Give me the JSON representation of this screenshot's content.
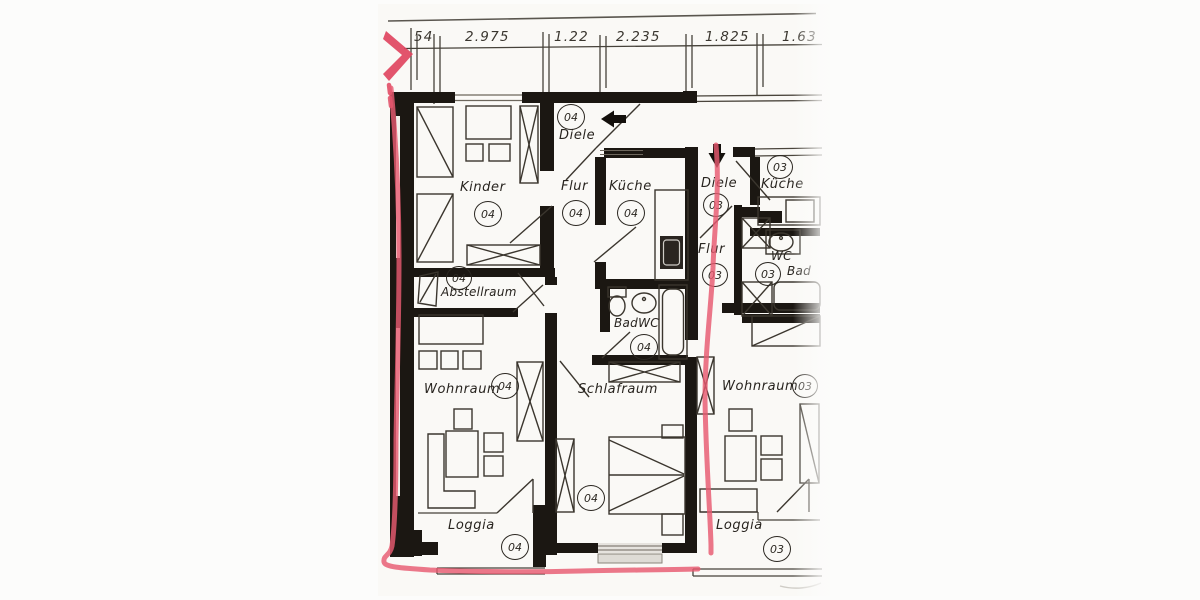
{
  "document": {
    "kind": "scanned apartment floor plan",
    "colors": {
      "marker_pink": "#e85a70",
      "wall_black": "#1b1712",
      "line_gray": "#3b362e",
      "paper": "#fcfcfb"
    }
  },
  "dimensions": {
    "values": [
      "54",
      "2.975",
      "1.22",
      "2.235",
      "1.825",
      "1.63"
    ]
  },
  "rooms": {
    "kinder": {
      "label": "Kinder",
      "num": "04"
    },
    "diele04": {
      "label": "Diele",
      "num": "04"
    },
    "flur04": {
      "label": "Flur",
      "num": "04"
    },
    "kueche04": {
      "label": "Küche",
      "num": "04"
    },
    "abstellraum": {
      "label": "Abstellraum",
      "num": "04"
    },
    "badwc": {
      "label": "BadWC",
      "num": "04"
    },
    "wohnraum04": {
      "label": "Wohnraum",
      "num": "04"
    },
    "schlafraum": {
      "label": "Schlafraum",
      "num": "04"
    },
    "loggia04": {
      "label": "Loggia",
      "num": "04"
    },
    "diele03": {
      "label": "Diele",
      "num": "03"
    },
    "kueche03": {
      "label": "Küche",
      "num": "03"
    },
    "flur03": {
      "label": "Flur",
      "num": "03"
    },
    "wc03": {
      "label": "WC",
      "num": "03"
    },
    "bad03": {
      "label": "Bad",
      "num": "03"
    },
    "wohnraum03": {
      "label": "Wohnraum",
      "num": "03"
    },
    "loggia03": {
      "label": "Loggia",
      "num": "03"
    }
  }
}
